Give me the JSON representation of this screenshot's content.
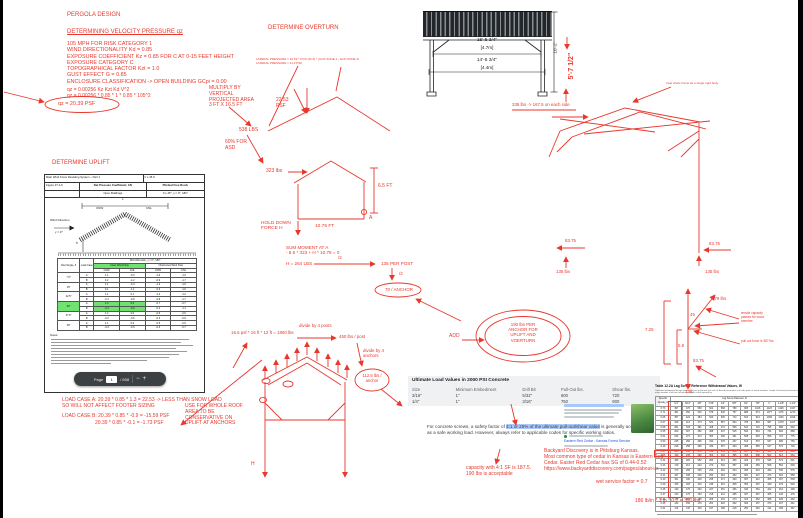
{
  "colors": {
    "red": "#e8372c",
    "green_highlight": "#6fe26f",
    "blue_highlight": "#abc8fb",
    "link_blue": "#1756d8"
  },
  "annotations": [
    {
      "n": "pergola-title",
      "t": "PERGOLA DESIGN",
      "x": 67,
      "y": 12,
      "fs": 6
    },
    {
      "n": "velocity-heading",
      "t": "DETERMINING VELOCITY PRESSURE qz",
      "x": 67,
      "y": 29,
      "fs": 6,
      "u": 1
    },
    {
      "n": "velocity-params",
      "t": "105 MPH FOR RISK CATEGORY 1\nWIND DIRECTIONALITY Kd = 0.85\nEXPOSURE COEFFICIENT Kz = 0.85 FOR C AT 0-15 FEET HEIGHT\nEXPOSURE CATEGORY C\nTOPOGRAPHICAL FACTOR Kzt = 1.0\nGUST EFFECT G = 0.85\nENCLOSURE CLASSIFICATION -> OPEN BUILDING GCpi = 0.00",
      "x": 67,
      "y": 41,
      "fs": 5.4,
      "lh": 6.3
    },
    {
      "n": "qz-formula",
      "t": "qz = 0.00256 Kz Kzt Kd V^2\nqz = 0.00256 * 0.85 * 1 * 0.85 * 105^2",
      "x": 67,
      "y": 88,
      "fs": 5,
      "lh": 5.8
    },
    {
      "n": "qz-result",
      "t": "qz = 20.39 PSF",
      "x": 58,
      "y": 101,
      "fs": 5.4
    },
    {
      "n": "overturn-heading",
      "t": "DETERMINE OVERTURN",
      "x": 268,
      "y": 25,
      "fs": 6
    },
    {
      "n": "lateral-pressure-calc",
      "t": "LATERAL PRESSURE = 22.53 * COS (30.6) * (GCP ZONE 1 - GCP ZONE 2)\nLATERAL PRESSURE = 11.3 PSF",
      "x": 256,
      "y": 58,
      "fs": 3,
      "lh": 3.6
    },
    {
      "n": "multiply-note",
      "t": "MULTIPLY BY\nVERTICAL\nPROJECTED AREA\n3 FT X 16.5 FT",
      "x": 209,
      "y": 86,
      "fs": 5,
      "lh": 5.8
    },
    {
      "n": "pressure-label",
      "t": "22.53\nPSF",
      "x": 276,
      "y": 98,
      "fs": 5,
      "lh": 5.6
    },
    {
      "n": "force-538",
      "t": "538 LBS",
      "x": 239,
      "y": 128,
      "fs": 5
    },
    {
      "n": "asd-note",
      "t": "60% FOR\nASD",
      "x": 225,
      "y": 140,
      "fs": 5,
      "lh": 5.6
    },
    {
      "n": "force-323",
      "t": "323 lbs",
      "x": 266,
      "y": 169,
      "fs": 5
    },
    {
      "n": "dim-6-5ft",
      "t": "6.5 FT",
      "x": 378,
      "y": 184,
      "fs": 5
    },
    {
      "n": "hold-down-label",
      "t": "HOLD DOWN\nFORCE H",
      "x": 261,
      "y": 221,
      "fs": 4.8,
      "lh": 5.4
    },
    {
      "n": "dim-10-75ft",
      "t": "10.75 FT",
      "x": 315,
      "y": 224,
      "fs": 4.8
    },
    {
      "n": "point-a-label",
      "t": "A",
      "x": 369,
      "y": 216,
      "fs": 5
    },
    {
      "n": "sum-moment",
      "t": "SUM MOMENT AT A\n- 8.5 * 323 + H * 10.75 = 0",
      "x": 286,
      "y": 245,
      "fs": 4.6,
      "lh": 5.4
    },
    {
      "n": "h-result",
      "t": "H = 264 LBS",
      "x": 286,
      "y": 261,
      "fs": 4.6
    },
    {
      "n": "divide-2-a",
      "t": "/2",
      "x": 338,
      "y": 255,
      "fs": 4.5
    },
    {
      "n": "per-post-135",
      "t": "135 PER POST",
      "x": 381,
      "y": 261,
      "fs": 4.6
    },
    {
      "n": "divide-2-b",
      "t": "/2",
      "x": 399,
      "y": 271,
      "fs": 4.5
    },
    {
      "n": "per-anchor-70",
      "t": "70 / ANCHOR",
      "x": 376,
      "y": 287,
      "fs": 4.5,
      "w": 46,
      "ta": "center"
    },
    {
      "n": "dim-15-5",
      "t": "15'-5 3/4\"",
      "x": 462,
      "y": 38,
      "fs": 4.8,
      "c": "k",
      "w": 50,
      "ta": "center"
    },
    {
      "n": "dim-15-5-m",
      "t": "[4.7m]",
      "x": 462,
      "y": 44.5,
      "fs": 4.6,
      "c": "k",
      "w": 50,
      "ta": "center"
    },
    {
      "n": "dim-14-5",
      "t": "14'-5 3/4\"",
      "x": 462,
      "y": 58,
      "fs": 4.8,
      "c": "k",
      "w": 50,
      "ta": "center"
    },
    {
      "n": "dim-14-5-m",
      "t": "[4.4m]",
      "x": 462,
      "y": 64.5,
      "fs": 4.6,
      "c": "k",
      "w": 50,
      "ta": "center"
    },
    {
      "n": "dim-height",
      "t": "10'-2\"",
      "x": 542,
      "y": 45,
      "fs": 4.6,
      "c": "k",
      "w": 26,
      "ta": "center",
      "rot": -90
    },
    {
      "n": "dim-5-7-red",
      "t": "5'-7 1/2\"",
      "x": 550,
      "y": 62,
      "fs": 7,
      "b": 1,
      "w": 44,
      "ta": "center",
      "rot": -90
    },
    {
      "n": "side-load-note",
      "t": "335 lbs -> 167.5 on each side",
      "x": 512,
      "y": 102,
      "fs": 4.4
    },
    {
      "n": "rigid-body-note",
      "t": "treat whole frame as a single rigid body",
      "x": 666,
      "y": 82,
      "fs": 3
    },
    {
      "n": "force-83-left",
      "t": "83.75",
      "x": 565,
      "y": 238,
      "fs": 4.4
    },
    {
      "n": "force-83-right",
      "t": "83.75",
      "x": 709,
      "y": 241,
      "fs": 4.4
    },
    {
      "n": "force-135-left",
      "t": "135 lbs",
      "x": 556,
      "y": 269,
      "fs": 4.4
    },
    {
      "n": "force-135-right",
      "t": "135 lbs",
      "x": 705,
      "y": 269,
      "fs": 4.4
    },
    {
      "n": "resultant-579",
      "t": "579 lbs",
      "x": 712,
      "y": 296,
      "fs": 4.4
    },
    {
      "n": "angle-45",
      "t": "45",
      "x": 690,
      "y": 312,
      "fs": 4.4
    },
    {
      "n": "dim-7-25",
      "t": "7.25",
      "x": 645,
      "y": 327,
      "fs": 4.4
    },
    {
      "n": "dim-5-8",
      "t": "5.8",
      "x": 678,
      "y": 343,
      "fs": 4.4
    },
    {
      "n": "force-83-fd",
      "t": "83.75",
      "x": 693,
      "y": 358,
      "fs": 4.4
    },
    {
      "n": "force-135-fd",
      "t": "135",
      "x": 685,
      "y": 389,
      "fs": 4.4
    },
    {
      "n": "tensile-note",
      "t": "tensile capacity\npasses for wood\nmember",
      "x": 741,
      "y": 312,
      "fs": 3.2,
      "lh": 3.9
    },
    {
      "n": "pullout-note",
      "t": "pull out force is 387 lbs",
      "x": 741,
      "y": 340,
      "fs": 3.2
    },
    {
      "n": "uplift-heading",
      "t": "DETERMINE UPLIFT",
      "x": 52,
      "y": 160,
      "fs": 6
    },
    {
      "n": "load-case-a",
      "t": "LOAD CASE A: 20.39 * 0.85 * 1.3 = 22.53 -> LESS THAN SNOW LOAD\nSO WILL NOT AFFECT FOOTER SIZING",
      "x": 62,
      "y": 397,
      "fs": 5,
      "lh": 6
    },
    {
      "n": "load-case-b1",
      "t": "LOAD CASE B: 20.39 * 0.85 * -0.9 = -15.59 PSF",
      "x": 62,
      "y": 414,
      "fs": 5
    },
    {
      "n": "load-case-b2",
      "t": "20.39 * 0.85 * -0.1 = -1.73 PSF",
      "x": 95,
      "y": 421,
      "fs": 5
    },
    {
      "n": "use-whole-roof-note",
      "t": "USE FOR WHOLE ROOF\nAREA TO BE\nCONSERVATIVE ON\nUPLIFT AT ANCHORS",
      "x": 185,
      "y": 404,
      "fs": 5,
      "lh": 5.8
    },
    {
      "n": "uplift-area-calc",
      "t": "15.6 psf * 16 ft * 12 ft = 1800 lbs",
      "x": 231,
      "y": 330,
      "fs": 4.4
    },
    {
      "n": "divide-4-posts",
      "t": "divide by 4 posts",
      "x": 299,
      "y": 323,
      "fs": 4.4
    },
    {
      "n": "per-post-450",
      "t": "450 lbs / post",
      "x": 339,
      "y": 334,
      "fs": 4.4
    },
    {
      "n": "divide-4-anchors",
      "t": "divide by 4\nanchors",
      "x": 363,
      "y": 348,
      "fs": 4.4,
      "lh": 5
    },
    {
      "n": "per-anchor-112",
      "t": "112.5 lbs /\nanchor",
      "x": 356,
      "y": 374,
      "fs": 4.2,
      "lh": 4.8,
      "w": 32,
      "ta": "center"
    },
    {
      "n": "h-stray",
      "t": "H",
      "x": 251,
      "y": 462,
      "fs": 5
    },
    {
      "n": "add-label",
      "t": "ADD",
      "x": 449,
      "y": 334,
      "fs": 5
    },
    {
      "n": "total-per-anchor",
      "t": "190 lbs PER\nANCHOR FOR\nUPLIFT AND\nVOERTURN",
      "x": 495,
      "y": 322,
      "fs": 4.4,
      "lh": 5.2,
      "w": 56,
      "ta": "center"
    },
    {
      "n": "capacity-note",
      "t": "capacity with 4:1 SF is 187.5.\n190 lbs is acceptable",
      "x": 466,
      "y": 465,
      "fs": 5,
      "lh": 6
    },
    {
      "n": "cedar-research-note",
      "t": "Backyard Discovery is in Pittsburg Kansas.\nMost common type of cedar in Kansas is Eastern Red\nCedar. Easter Red Cedar has SG of 0.44-0.52:\nhttps://www.backyarddiscovery.com/pages/about-us",
      "x": 544,
      "y": 448,
      "fs": 5,
      "lh": 6
    },
    {
      "n": "wet-service-note",
      "t": "wet service factor = 0.7",
      "x": 596,
      "y": 480,
      "fs": 5
    },
    {
      "n": "withdrawal-calc",
      "t": "186 lb/in * 3 in * 0.7 = 391 lbs",
      "x": 635,
      "y": 499,
      "fs": 5
    },
    {
      "n": "asce-wind-direction",
      "t": "Wind Direction",
      "x": 50,
      "y": 219,
      "fs": 3,
      "c": "k"
    },
    {
      "n": "asce-gamma",
      "t": "γ = 0°",
      "x": 55,
      "y": 231,
      "fs": 3,
      "c": "k"
    },
    {
      "n": "asce-dim-l",
      "t": "L",
      "x": 122,
      "y": 198,
      "fs": 3.2,
      "c": "k"
    },
    {
      "n": "asce-dim-h",
      "t": "h",
      "x": 76,
      "y": 242,
      "fs": 3.2,
      "c": "k"
    },
    {
      "n": "asce-cnw",
      "t": "CNW",
      "x": 96,
      "y": 207,
      "fs": 3,
      "c": "k"
    },
    {
      "n": "asce-cnl",
      "t": "CNL",
      "x": 146,
      "y": 207,
      "fs": 3,
      "c": "k"
    },
    {
      "n": "asce-notes-label",
      "t": "Notes:",
      "x": 50,
      "y": 334,
      "fs": 2.8,
      "c": "k"
    }
  ],
  "asce": {
    "header_row1_left": "Main Wind Force Resisting System – Part 1",
    "header_row1_right": "h ≤ 45 ft.",
    "figure_no": "Figure 27.4-5",
    "figure_title": "Net Pressure Coefficient, CN",
    "figure_right1": "Pitched Free Roofs",
    "figure_right2": "θ ≤ 45°, γ = 0°, 180°",
    "building": "Open Buildings",
    "table": {
      "span_header": "Wind Direction, γ = 0°, 180°",
      "col1": "Roof Angle, θ",
      "col2": "Load Case",
      "clear": "Clear Wind Flow",
      "obstructed": "Obstructed Wind Flow",
      "sub": [
        "CNW",
        "CNL",
        "CNW",
        "CNL"
      ],
      "rows": [
        {
          "a": "7.5°",
          "c": "A",
          "v": [
            "1.1",
            "-0.3",
            "-1.6",
            "-1.0"
          ]
        },
        {
          "a": "",
          "c": "B",
          "v": [
            "0.2",
            "-1.2",
            "-0.9",
            "-1.7"
          ]
        },
        {
          "a": "15°",
          "c": "A",
          "v": [
            "1.1",
            "-0.4",
            "-1.2",
            "-1.0"
          ]
        },
        {
          "a": "",
          "c": "B",
          "v": [
            "0.1",
            "-1.1",
            "-0.6",
            "-1.6"
          ]
        },
        {
          "a": "22.5°",
          "c": "A",
          "v": [
            "1.1",
            "0.1",
            "-1.2",
            "-1.2"
          ]
        },
        {
          "a": "",
          "c": "B",
          "v": [
            "-0.1",
            "-0.8",
            "-0.8",
            "-1.7"
          ]
        },
        {
          "a": "30°",
          "c": "A",
          "v": [
            "1.3",
            "0.3",
            "-0.7",
            "-0.7"
          ],
          "ha": true,
          "hl": [
            0,
            1
          ]
        },
        {
          "a": "",
          "c": "B",
          "v": [
            "-0.1",
            "-0.9",
            "-0.2",
            "-1.1"
          ],
          "hl": [
            0,
            1
          ]
        },
        {
          "a": "37.5°",
          "c": "A",
          "v": [
            "1.3",
            "0.6",
            "-0.6",
            "-0.6"
          ]
        },
        {
          "a": "",
          "c": "B",
          "v": [
            "-0.2",
            "-0.6",
            "-0.3",
            "-0.9"
          ]
        },
        {
          "a": "45°",
          "c": "A",
          "v": [
            "1.1",
            "0.9",
            "-0.5",
            "-0.5"
          ]
        },
        {
          "a": "",
          "c": "B",
          "v": [
            "-0.3",
            "-0.5",
            "-0.3",
            "-0.7"
          ]
        }
      ]
    },
    "toolbar": {
      "page_label": "Page",
      "page_value": "1",
      "page_total": "/ 658",
      "zoom_out": "−",
      "zoom_in": "+"
    }
  },
  "concrete": {
    "title": "Ultimate Load Values in 2000 PSI Concrete",
    "headers": [
      "Size",
      "Minimum Embedment",
      "Drill Bit",
      "Pull-Out lbs.",
      "Shear lbs."
    ],
    "rows": [
      [
        "3/16\"",
        "1\"",
        "5/32\"",
        "600",
        "720"
      ],
      [
        "1/4\"",
        "1\"",
        "3/16\"",
        "750",
        "900"
      ]
    ]
  },
  "safety": {
    "pre": "For concrete screws, a safety factor of ",
    "highlight": "4:1 or 25% of the ultimate pull-out/shear value",
    "post": " is generally accepted as a safe working load. However, always refer to applicable codes for specific working ratios."
  },
  "cedar": {
    "link": "Eastern Red Cedar - Kansas Forest Service"
  },
  "lag": {
    "caption": "Table 12.2A    Lag Screw Reference Withdrawal Values, W",
    "subtitle": "Tabulated withdrawal design values (W) are in pounds per inch of thread penetration into side grain of wood member. Length of thread penetration in main member shall not include the length of the tapered tip.",
    "row_group": "Specific Gravity, G",
    "col_group": "Lag Screw Diameter, D",
    "diameters": [
      "1/4\"",
      "5/16\"",
      "3/8\"",
      "7/16\"",
      "1/2\"",
      "5/8\"",
      "3/4\"",
      "7/8\"",
      "1\"",
      "1-1/8\"",
      "1-1/4\""
    ],
    "rows": [
      [
        "0.73",
        397,
        470,
        538,
        604,
        668,
        789,
        905,
        1016,
        1123,
        1226,
        1327
      ],
      [
        "0.71",
        381,
        450,
        516,
        579,
        640,
        757,
        868,
        974,
        1077,
        1176,
        1273
      ],
      [
        "0.68",
        357,
        422,
        484,
        543,
        600,
        710,
        813,
        913,
        1009,
        1103,
        1193
      ],
      [
        "0.67",
        349,
        413,
        473,
        531,
        587,
        694,
        795,
        893,
        987,
        1078,
        1167
      ],
      [
        "0.58",
        281,
        333,
        381,
        428,
        473,
        559,
        641,
        719,
        795,
        868,
        940
      ],
      [
        "0.55",
        260,
        307,
        352,
        395,
        437,
        516,
        592,
        664,
        734,
        802,
        868
      ],
      [
        "0.51",
        232,
        274,
        314,
        353,
        390,
        461,
        528,
        593,
        656,
        716,
        775
      ],
      [
        "0.50",
        225,
        266,
        305,
        342,
        378,
        447,
        513,
        576,
        637,
        695,
        753
      ],
      [
        "0.49",
        218,
        258,
        296,
        332,
        367,
        434,
        498,
        559,
        617,
        674,
        730
      ],
      [
        "0.47",
        205,
        243,
        278,
        312,
        345,
        408,
        467,
        525,
        580,
        634,
        686
      ],
      [
        "0.46",
        199,
        235,
        269,
        302,
        334,
        395,
        453,
        508,
        562,
        613,
        664
      ],
      [
        "0.44",
        186,
        220,
        252,
        283,
        312,
        369,
        423,
        475,
        525,
        574,
        621
      ],
      [
        "0.43",
        179,
        212,
        243,
        273,
        302,
        357,
        409,
        459,
        508,
        554,
        600
      ],
      [
        "0.42",
        173,
        205,
        235,
        264,
        291,
        344,
        395,
        443,
        490,
        535,
        579
      ],
      [
        "0.41",
        167,
        198,
        226,
        254,
        281,
        332,
        381,
        427,
        473,
        516,
        559
      ],
      [
        "0.40",
        161,
        190,
        218,
        245,
        271,
        320,
        367,
        412,
        455,
        497,
        538
      ],
      [
        "0.39",
        155,
        183,
        210,
        236,
        261,
        308,
        353,
        397,
        439,
        479,
        518
      ],
      [
        "0.38",
        149,
        176,
        202,
        227,
        251,
        296,
        340,
        381,
        422,
        461,
        499
      ],
      [
        "0.37",
        143,
        170,
        194,
        218,
        241,
        285,
        327,
        367,
        405,
        443,
        479
      ],
      [
        "0.36",
        137,
        163,
        186,
        209,
        231,
        273,
        313,
        352,
        389,
        425,
        460
      ],
      [
        "0.35",
        132,
        156,
        179,
        201,
        222,
        262,
        300,
        337,
        373,
        407,
        441
      ],
      [
        "0.31",
        110,
        130,
        149,
        167,
        185,
        218,
        250,
        281,
        311,
        339,
        367
      ]
    ],
    "highlight": {
      "g": "0.44",
      "diameter": "1/4\"",
      "value": 186
    }
  }
}
